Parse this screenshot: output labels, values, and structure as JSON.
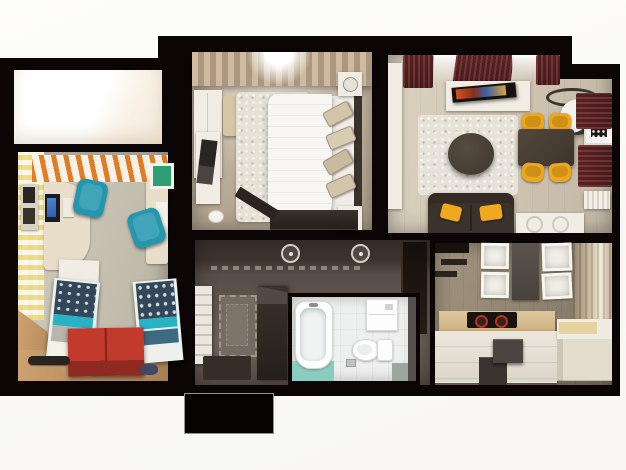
{
  "scene": {
    "kind": "3d-apartment-floor-plan-render",
    "view": "top-down dollhouse",
    "background_color": "#fbfbf8",
    "wall_color": "#0b0505"
  },
  "palette": {
    "accent_orange_stripes": "#e2791c",
    "accent_teal_chair": "#2496ad",
    "accent_red_chest": "#b23127",
    "accent_yellow_chair": "#eca81d",
    "accent_yellow_pillow": "#f0a81c",
    "accent_burgundy_curtain": "#642527",
    "accent_teal_mat": "#8bccc0",
    "sofa_brown": "#3b332b",
    "bed_white": "#f7f6f3",
    "kitchen_counter_wood": "#d9bd92",
    "hall_floor": "#5f564e",
    "kids_navy_blanket": "#32485a",
    "kids_teal_blanket": "#28b2c4",
    "green_board": "#2f9e74",
    "burner_red": "#b33222"
  },
  "rooms": {
    "balcony": {
      "label": "balcony",
      "objects": [
        "bright-window-light"
      ]
    },
    "kids_room": {
      "label": "kids-room",
      "objects": [
        "orange-slat-blinds",
        "yellow-check-wallpaper",
        "corner-desk",
        "monitor",
        "green-pin-board",
        "two-teal-office-chairs",
        "white-cabinet",
        "two-beds-teal-navy-bedding",
        "red-storage-chest",
        "skateboard",
        "slipper"
      ]
    },
    "bedroom": {
      "label": "master-bedroom",
      "objects": [
        "tan-curtains",
        "window",
        "white-wardrobe",
        "beige-ottoman",
        "white-console-with-magazine",
        "white-shag-rug",
        "double-bed-white-duvet",
        "four-beige-pillows",
        "dark-headboard",
        "two-nightstands-with-lamps",
        "dark-dresser",
        "white-cup"
      ]
    },
    "living_room": {
      "label": "living-room",
      "objects": [
        "burgundy-curtains",
        "tv-on-white-console",
        "ceiling-ring-lamp",
        "white-cylinder-pendant",
        "framed-art",
        "white-shag-rug",
        "round-dark-coffee-table",
        "dark-dining-table",
        "four-yellow-chairs",
        "dark-sofa-yellow-pillows",
        "white-sideboard",
        "white-radiator"
      ]
    },
    "hallway": {
      "label": "hallway",
      "objects": [
        "two-ceiling-lights",
        "runner-rug-dashed-border",
        "white-ladder-shelf",
        "dark-wardrobe",
        "dark-doormat",
        "dark-doorway"
      ]
    },
    "bathroom": {
      "label": "bathroom",
      "objects": [
        "bathtub",
        "toilet",
        "wall-cabinet",
        "teal-floor-mat",
        "grey-mat"
      ]
    },
    "kitchen": {
      "label": "kitchen",
      "objects": [
        "open-white-wall-cabinets",
        "dark-tall-cabinet",
        "black-wall-shelves",
        "wood-countertop",
        "black-cooktop-red-burners",
        "white-base-drawers",
        "dark-step-stool",
        "white-island",
        "tan-window-curtains"
      ]
    },
    "entrance": {
      "label": "entrance-stub"
    }
  }
}
